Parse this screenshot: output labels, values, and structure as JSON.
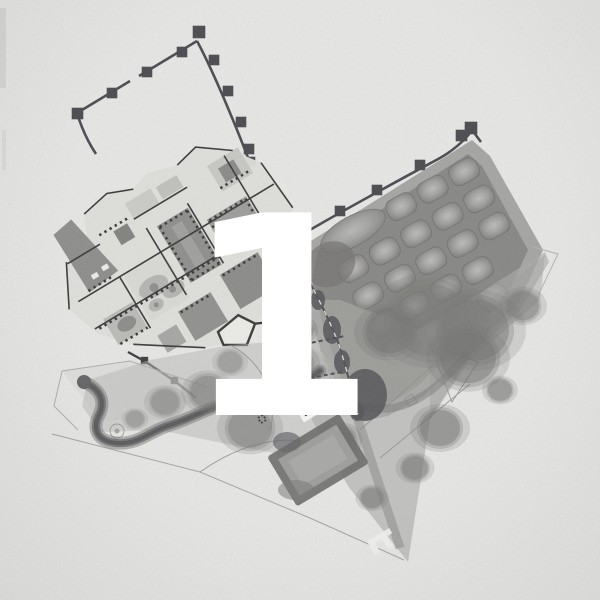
{
  "figure": {
    "numeral": "1",
    "kind": "architectural-site-plan",
    "regions": [
      {
        "name": "fortified-enclosure"
      },
      {
        "name": "palace-complex"
      },
      {
        "name": "terraced-parterre-garden"
      },
      {
        "name": "landscape-park"
      }
    ]
  },
  "palette": {
    "paper": "#e8e8e7",
    "ink": "#3c3c3c",
    "wall": "#4c4c50",
    "palaceBase": "#dcdcd8",
    "courtDark": "#8d8d8b",
    "courtMid": "#9d9d9b",
    "courtLight": "#d7d7d3",
    "terrace": "#9b9b99",
    "terraceInner": "#868684",
    "bedCenter": "#b7b7b5",
    "parkWash": "#a9a9a7",
    "treeDark": "#6f6f6d",
    "pathDark": "#646466",
    "pondRim": "#6c6c6a",
    "numeral": "#ffffff"
  }
}
